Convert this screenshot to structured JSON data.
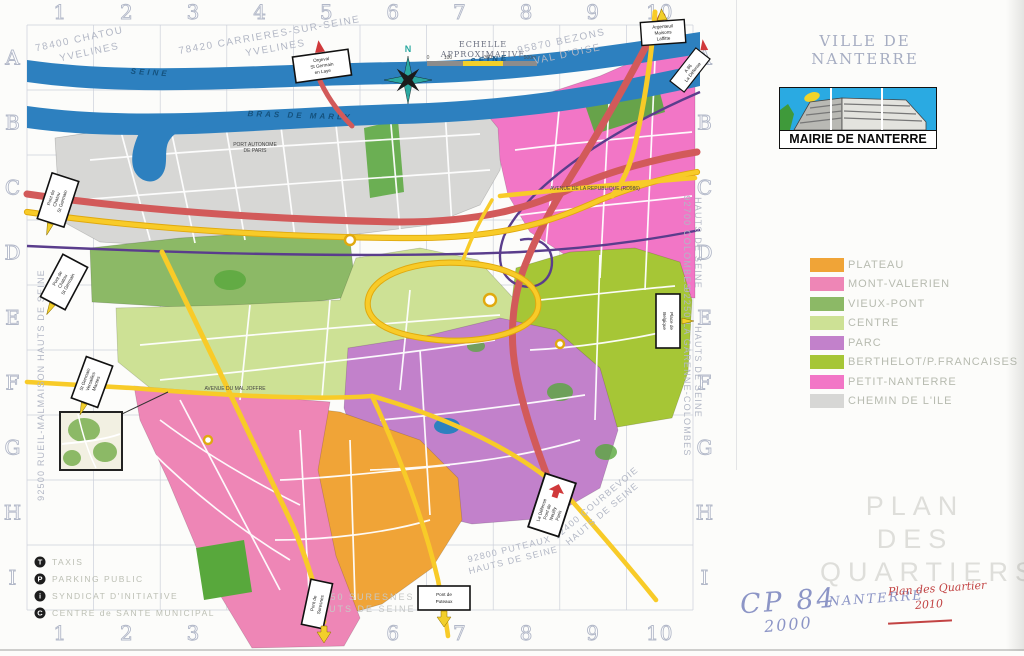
{
  "header": {
    "ville": "VILLE DE NANTERRE",
    "mairie": "MAIRIE DE NANTERRE"
  },
  "grid": {
    "cols": [
      "1",
      "2",
      "3",
      "4",
      "5",
      "6",
      "7",
      "8",
      "9",
      "10"
    ],
    "rows": [
      "A",
      "B",
      "C",
      "D",
      "E",
      "F",
      "G",
      "H",
      "I"
    ]
  },
  "neighbors": {
    "chatou": [
      "78400 CHATOU",
      "YVELINES"
    ],
    "carrieres": [
      "78420 CARRIERES-SUR-SEINE",
      "YVELINES"
    ],
    "bezons": [
      "95870 BEZONS",
      "VAL D'OISE"
    ],
    "colombes": [
      "92700 COLOMBES",
      "HAUTS DE SEINE"
    ],
    "garenne": [
      "92250 LA GARENNE-COLOMBES",
      "HAUTS DE SEINE"
    ],
    "rueil": "92500 RUEIL-MALMAISON HAUTS DE SEINE",
    "courbevoie": [
      "92400 COURBEVOIE",
      "HAUTS DE SEINE"
    ],
    "puteaux": [
      "92800 PUTEAUX",
      "HAUTS DE SEINE"
    ],
    "suresnes": [
      "92150 SURESNES",
      "HAUTS DE SEINE"
    ]
  },
  "river": {
    "label1": "SEINE",
    "label2": "SEINE",
    "label3": "BRAS DE MARLY"
  },
  "scale": {
    "line1": "ECHELLE",
    "line2": "APPROXIMATIVE",
    "ticks": [
      "0",
      "100",
      "300",
      "500m"
    ]
  },
  "compass": {
    "north": "N"
  },
  "signs": {
    "orgeval": [
      "Orgeval",
      "St Germain",
      "en Laye"
    ],
    "argenteuil": [
      "Argenteuil",
      "Maisons",
      "Laffitte"
    ],
    "a86": [
      "A 86",
      "La Défense"
    ],
    "pont_chatou": [
      "Pont de",
      "Chatou",
      "St Germain"
    ],
    "st_germain": [
      "St Germain",
      "Versailles",
      "Mantes"
    ],
    "belgique": [
      "Place de",
      "Belgique"
    ],
    "defense": [
      "La Défense",
      "Pont de",
      "Neuilly",
      "Paris"
    ],
    "pont_puteaux": [
      "Pont de",
      "Puteaux"
    ],
    "pont_suresnes": [
      "Pont de",
      "Suresnes"
    ]
  },
  "streets": {
    "republique": "AVENUE DE LA REPUBLIQUE (RD986)",
    "joffre": "AVENUE DU MAL JOFFRE",
    "port": [
      "PORT AUTONOME",
      "DE PARIS"
    ]
  },
  "legend": {
    "items": [
      {
        "label": "PLATEAU",
        "color": "#f0a437"
      },
      {
        "label": "MONT-VALERIEN",
        "color": "#ee86b6"
      },
      {
        "label": "VIEUX-PONT",
        "color": "#8cb966"
      },
      {
        "label": "CENTRE",
        "color": "#cde195"
      },
      {
        "label": "PARC",
        "color": "#c281cb"
      },
      {
        "label": "BERTHELOT/P.FRANCAISES",
        "color": "#a6c636"
      },
      {
        "label": "PETIT-NANTERRE",
        "color": "#f276c6"
      },
      {
        "label": "CHEMIN DE L'ILE",
        "color": "#d7d7d5"
      }
    ]
  },
  "poi": {
    "items": [
      {
        "icon": "T",
        "label": "TAXIS"
      },
      {
        "icon": "P",
        "label": "PARKING PUBLIC"
      },
      {
        "icon": "i",
        "label": "SYNDICAT D'INITIATIVE"
      },
      {
        "icon": "C",
        "label": "CENTRE de SANTE MUNICIPAL"
      }
    ]
  },
  "title_block": {
    "lines": [
      "PLAN",
      "DES",
      "QUARTIERS"
    ]
  },
  "handwriting": {
    "cp": "CP 84",
    "year_blue": "2000",
    "city": "- NANTERRE",
    "red_title": "Plan des Quartier",
    "red_year": "2010"
  }
}
